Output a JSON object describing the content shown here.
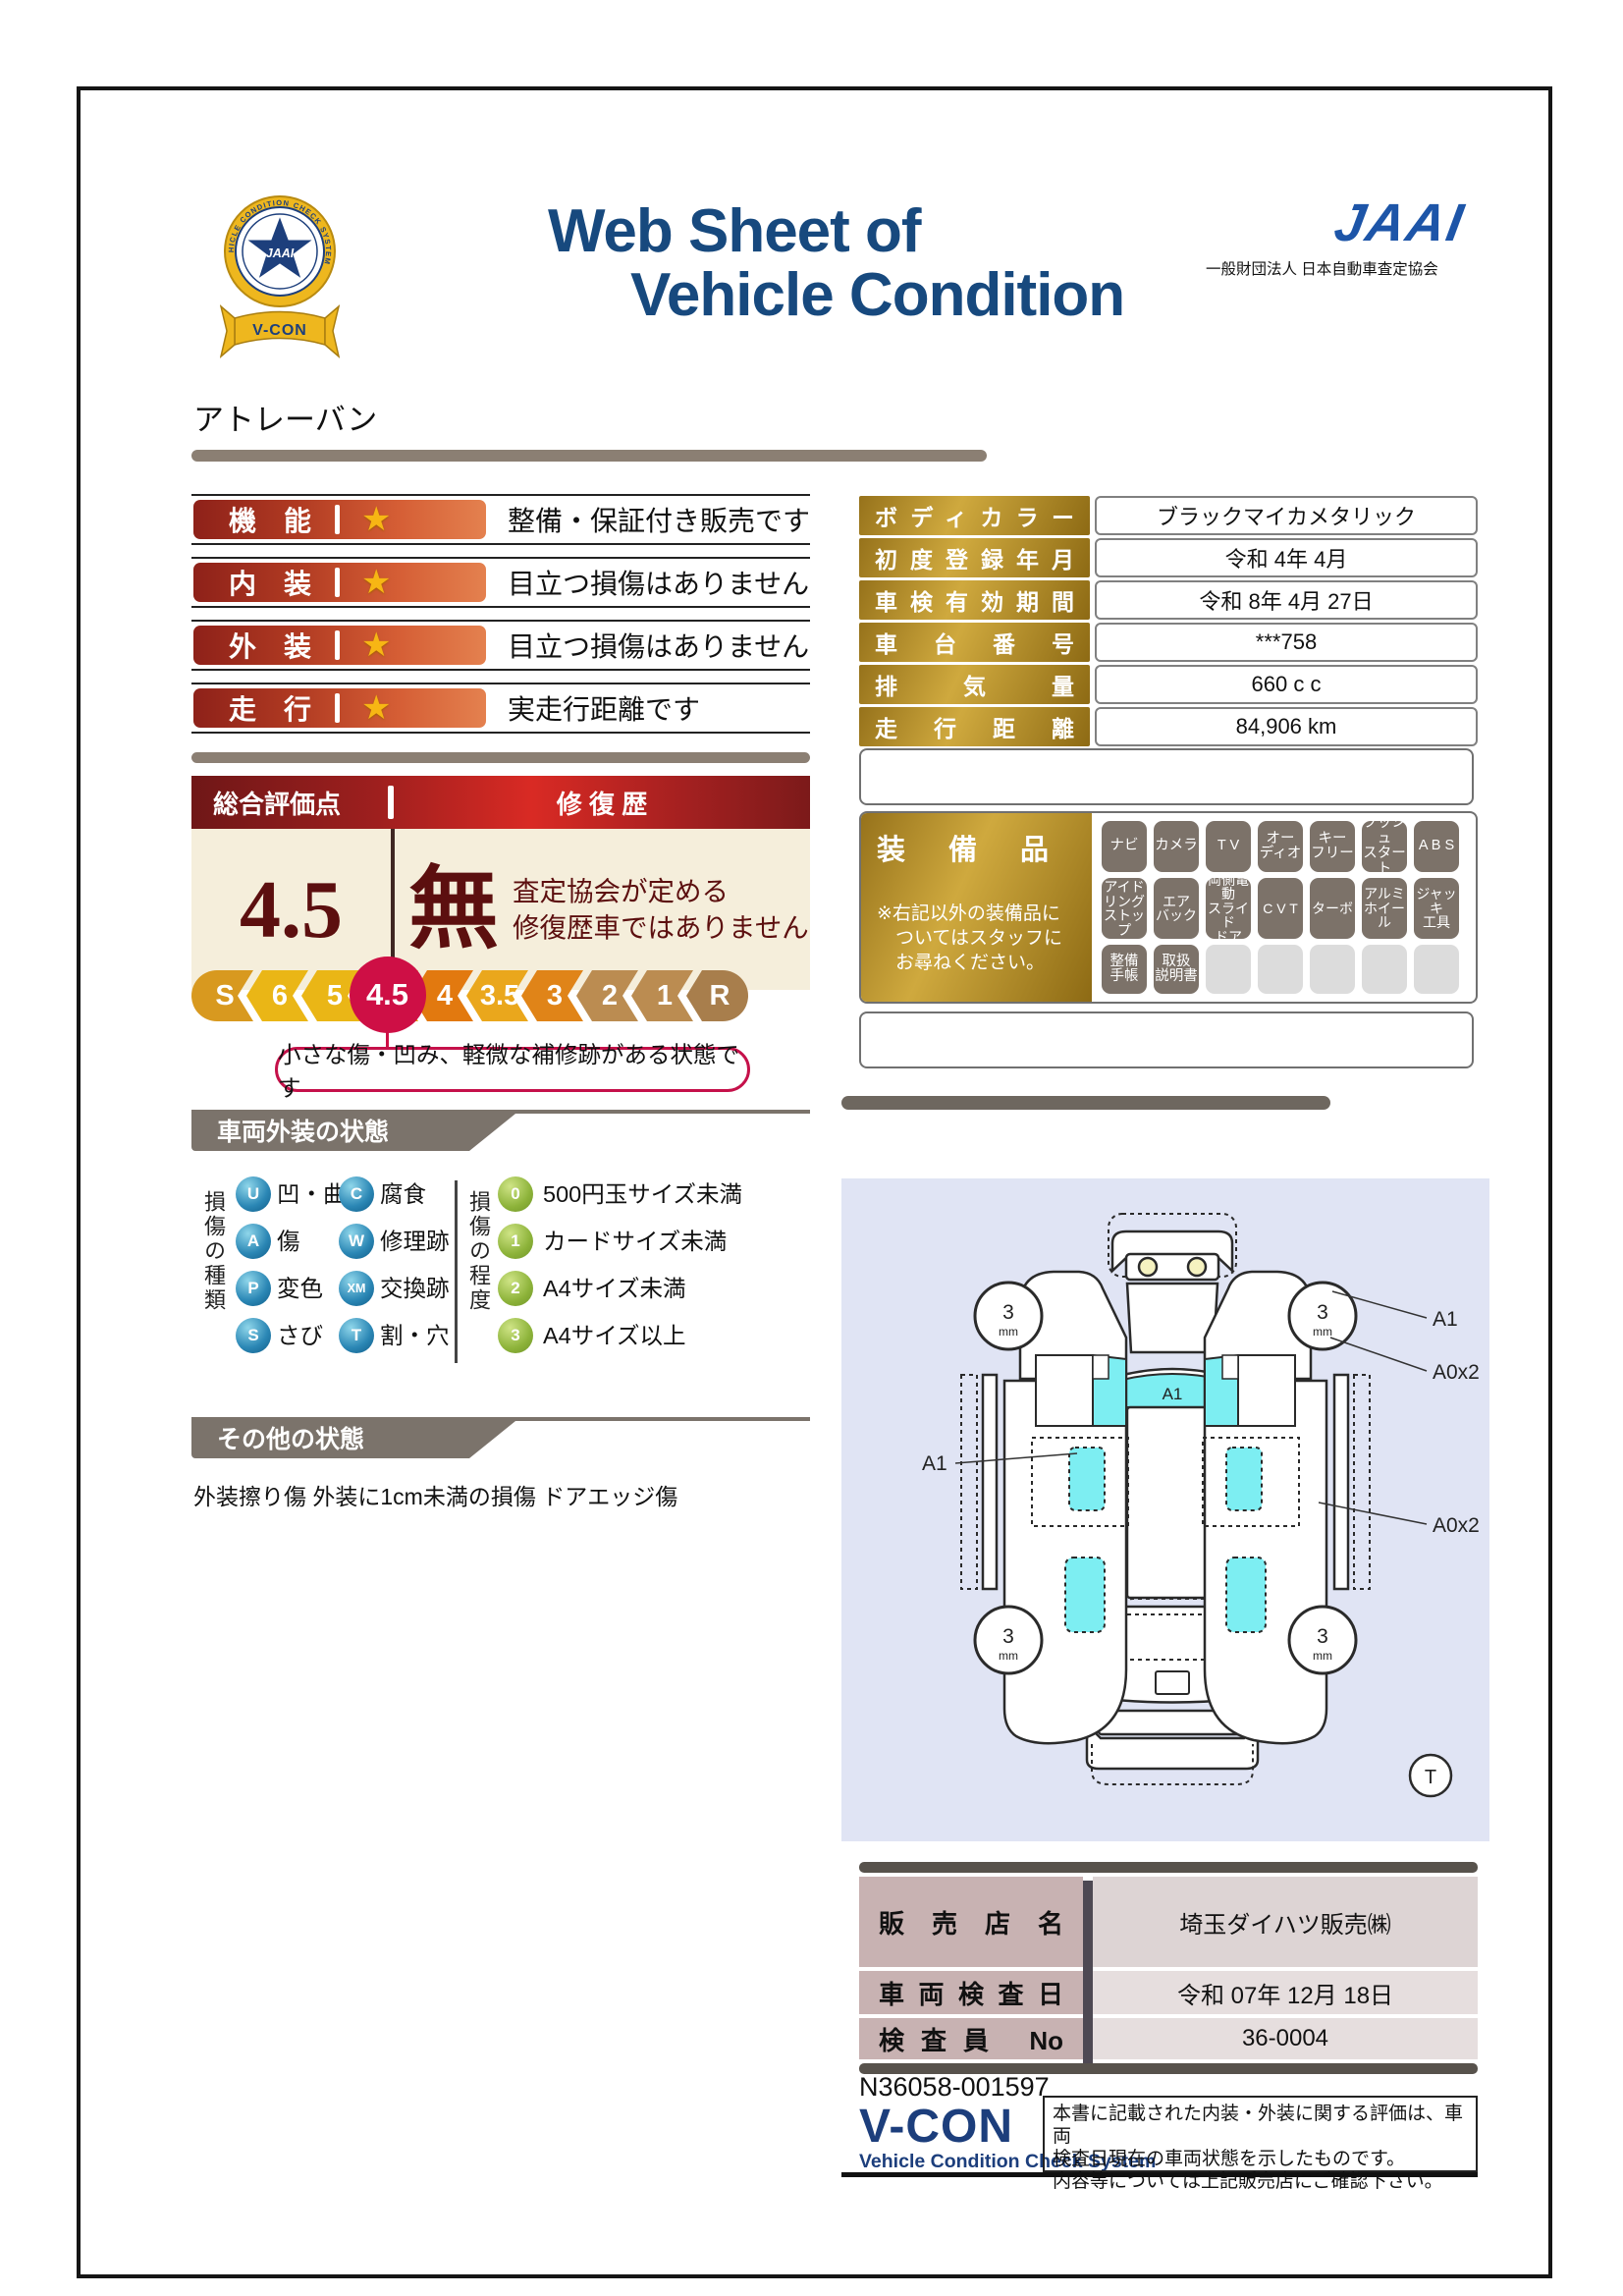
{
  "header": {
    "title_line1": "Web Sheet of",
    "title_line2": "Vehicle Condition",
    "jaai_wordmark": "JAAI",
    "jaai_subtitle": "一般財団法人 日本自動車査定協会",
    "emblem_ring_text": "VEHICLE CONDITION CHECK SYSTEM",
    "emblem_center": "JAAI",
    "emblem_ribbon": "V-CON"
  },
  "vehicle_name": "アトレーバン",
  "ratings": [
    {
      "label": "機　能",
      "star": "★",
      "desc": "整備・保証付き販売です"
    },
    {
      "label": "内　装",
      "star": "★",
      "desc": "目立つ損傷はありません"
    },
    {
      "label": "外　装",
      "star": "★",
      "desc": "目立つ損傷はありません"
    },
    {
      "label": "走　行",
      "star": "★",
      "desc": "実走行距離です"
    }
  ],
  "overall": {
    "header_left": "総合評価点",
    "header_right": "修 復 歴",
    "score": "4.5",
    "repair_mark": "無",
    "repair_note1": "査定協会が定める",
    "repair_note2": "修復歴車ではありません",
    "callout": "小さな傷・凹み、軽微な補修跡がある状態です",
    "scale": [
      {
        "label": "S",
        "color": "#d8991f",
        "active": false
      },
      {
        "label": "6",
        "color": "#eab616",
        "active": false
      },
      {
        "label": "5",
        "color": "#eab616",
        "active": false
      },
      {
        "label": "4.5",
        "color": "#e8a214",
        "active": true,
        "active_color": "#ce0f45"
      },
      {
        "label": "4",
        "color": "#e2790f",
        "active": false
      },
      {
        "label": "3.5",
        "color": "#eaa71c",
        "active": false
      },
      {
        "label": "3",
        "color": "#e08418",
        "active": false
      },
      {
        "label": "2",
        "color": "#bb8c51",
        "active": false
      },
      {
        "label": "1",
        "color": "#bb8c51",
        "active": false
      },
      {
        "label": "R",
        "color": "#a87e4c",
        "active": false
      }
    ]
  },
  "details": {
    "rows": [
      {
        "label": "ボディカラー",
        "value": "ブラックマイカメタリック"
      },
      {
        "label": "初度登録年月",
        "value": "令和 4年 4月"
      },
      {
        "label": "車検有効期間",
        "value": "令和 8年 4月 27日"
      },
      {
        "label": "車台番号",
        "value": "***758"
      },
      {
        "label": "排気量",
        "value": "660 c c"
      },
      {
        "label": "走行距離",
        "value": "84,906 km"
      }
    ]
  },
  "equipment": {
    "title": "装備品",
    "note1": "※右記以外の装備品に",
    "note2": "ついてはスタッフに",
    "note3": "お尋ねください。",
    "rows": [
      [
        {
          "label": "ナビ",
          "active": true
        },
        {
          "label": "カメラ",
          "active": true
        },
        {
          "label": "T V",
          "active": true
        },
        {
          "label": "オー\nディオ",
          "active": true
        },
        {
          "label": "キー\nフリー",
          "active": true
        },
        {
          "label": "プッシュ\nスタート",
          "active": true
        },
        {
          "label": "A B S",
          "active": true
        }
      ],
      [
        {
          "label": "アイド\nリング\nストップ",
          "active": true
        },
        {
          "label": "エア\nバック",
          "active": true
        },
        {
          "label": "両側電動\nスライド\nドア",
          "active": true
        },
        {
          "label": "C V T",
          "active": true
        },
        {
          "label": "ターボ",
          "active": true
        },
        {
          "label": "アルミ\nホイール",
          "active": true
        },
        {
          "label": "ジャッキ\n工具",
          "active": true
        }
      ],
      [
        {
          "label": "整備\n手帳",
          "active": true
        },
        {
          "label": "取扱\n説明書",
          "active": true
        },
        {
          "label": "",
          "active": false
        },
        {
          "label": "",
          "active": false
        },
        {
          "label": "",
          "active": false
        },
        {
          "label": "",
          "active": false
        },
        {
          "label": "",
          "active": false
        }
      ]
    ]
  },
  "exterior": {
    "section_title": "車両外装の状態",
    "type_axis": "損傷の種類",
    "types": [
      {
        "code": "U",
        "label": "凹・曲"
      },
      {
        "code": "A",
        "label": "傷"
      },
      {
        "code": "P",
        "label": "変色"
      },
      {
        "code": "S",
        "label": "さび"
      },
      {
        "code": "C",
        "label": "腐食"
      },
      {
        "code": "W",
        "label": "修理跡"
      },
      {
        "code": "XM",
        "label": "交換跡"
      },
      {
        "code": "T",
        "label": "割・穴"
      }
    ],
    "degree_axis": "損傷の程度",
    "degrees": [
      {
        "code": "0",
        "label": "500円玉サイズ未満"
      },
      {
        "code": "1",
        "label": "カードサイズ未満"
      },
      {
        "code": "2",
        "label": "A4サイズ未満"
      },
      {
        "code": "3",
        "label": "A4サイズ以上"
      }
    ]
  },
  "other": {
    "section_title": "その他の状態",
    "text": "外装擦り傷 外装に1cm未満の損傷 ドアエッジ傷"
  },
  "diagram": {
    "tread_value": "3",
    "tread_unit": "mm",
    "label_windshield": "A1",
    "label_left_side": "A1",
    "label_right_front": "A1",
    "label_right_upper": "A0x2",
    "label_right_lower": "A0x2",
    "tire_mark": "T"
  },
  "dealer": {
    "rows": [
      {
        "label": "販売店名",
        "value": "埼玉ダイハツ販売㈱"
      },
      {
        "label": "車両検査日",
        "value": "令和 07年 12月 18日"
      },
      {
        "label": "検査員 No",
        "value": "36-0004"
      }
    ]
  },
  "footer": {
    "serial": "N36058-001597",
    "vcon": "V-CON",
    "vcon_sub": "Vehicle Condition Check System",
    "disclaimer_line1": "本書に記載された内装・外装に関する評価は、車両",
    "disclaimer_line2": "検査日現在の車両状態を示したものです。",
    "disclaimer_line3": "内容等については上記販売店にご確認下さい。"
  }
}
